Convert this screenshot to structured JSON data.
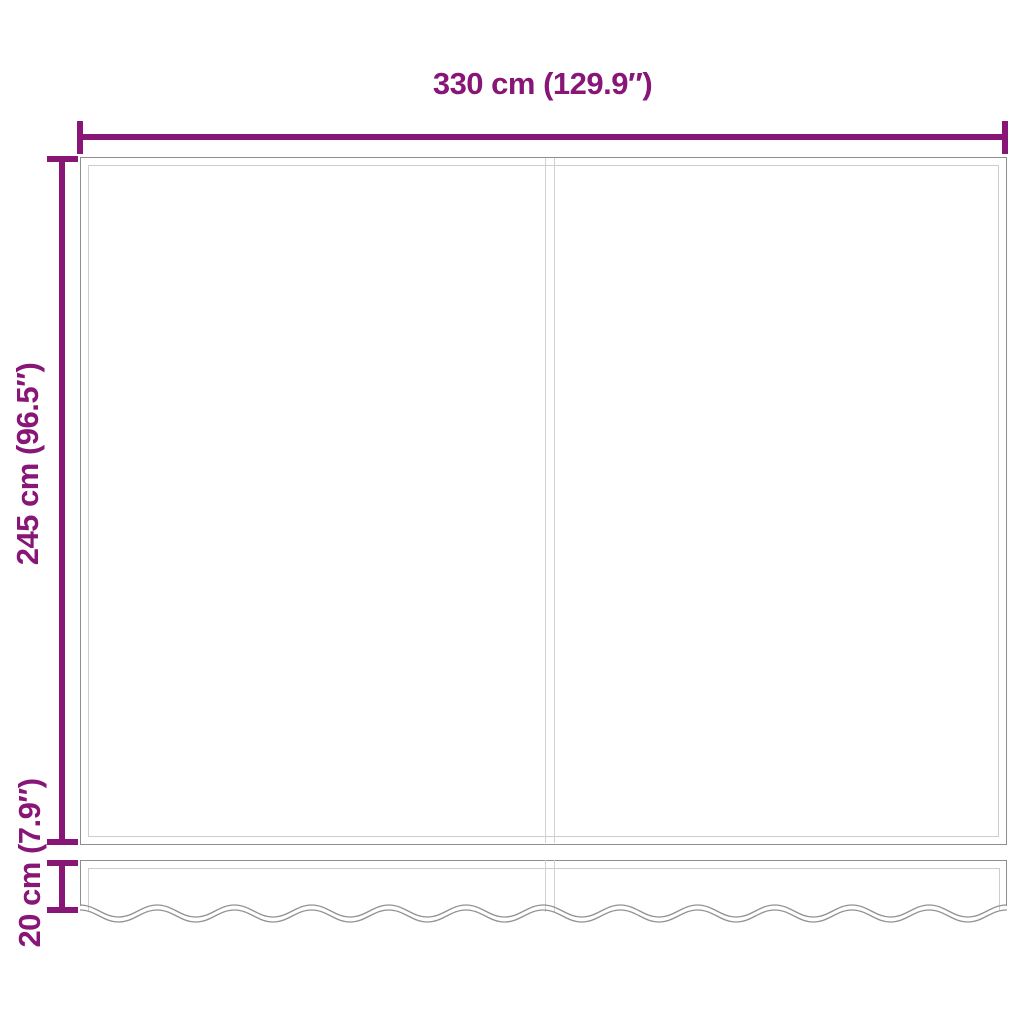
{
  "diagram": {
    "labels": {
      "width": "330 cm (129.9″)",
      "height": "245 cm (96.5″)",
      "valance": "20 cm (7.9″)"
    },
    "colors": {
      "dimension": "#871677",
      "line_dark": "#8e8e8e",
      "line_light": "#cdcdcd",
      "seam": "#d2d2d2",
      "wave": "#929292",
      "background": "#ffffff"
    }
  }
}
